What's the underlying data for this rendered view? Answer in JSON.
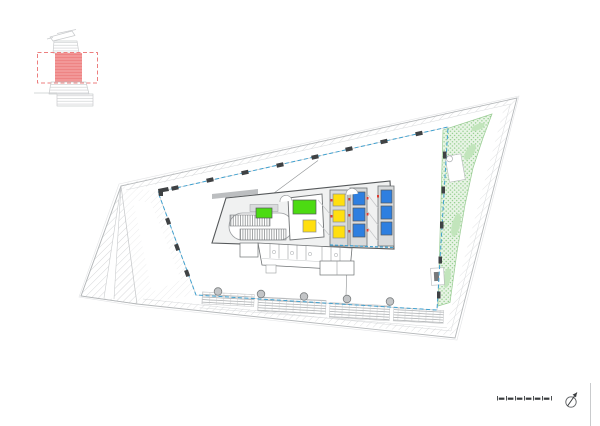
{
  "sheet": {
    "background_color": "#ffffff"
  },
  "colors": {
    "hatch": "#c7c9cb",
    "line_light": "#c9cbcd",
    "line_mid": "#8f9294",
    "line_dark": "#55585a",
    "wall_fill": "#d9dbdc",
    "facade_blue": "#3fa0cf",
    "room_green": "#4cdb12",
    "room_yellow": "#ffdf0f",
    "lift_blue": "#2e7fe0",
    "marker_red": "#e0392e",
    "terrace_fill": "#e8f4e5",
    "terrace_dot": "#8ccb86",
    "terrace_edge": "#9ccd96",
    "terrace_blob": "#c2e5bc",
    "keyplan_red_fill": "#f29898",
    "keyplan_red_line": "#ec7f7f",
    "keyplan_gray": "#c9cbcd",
    "column_dark": "#3f4244",
    "column_circle_fill": "#c3c5c7",
    "scalebar_ink": "#3a3d3f"
  },
  "key_plan": {
    "floors_highlighted": 1
  },
  "core": {
    "green_rooms": 2,
    "yellow_rooms": 1,
    "lift_banks": [
      {
        "color_key": "room_yellow",
        "cells": 3
      },
      {
        "color_key": "lift_blue",
        "cells": 3
      },
      {
        "color_key": "lift_blue",
        "cells": 3
      }
    ]
  },
  "perimeter": {
    "top_edge_columns": 8,
    "left_edge_columns": 3,
    "right_edge_columns": 5,
    "bottom_edge_columns": 5
  },
  "scale_bar": {
    "segments": 6
  },
  "north_arrow": {
    "present": true
  }
}
